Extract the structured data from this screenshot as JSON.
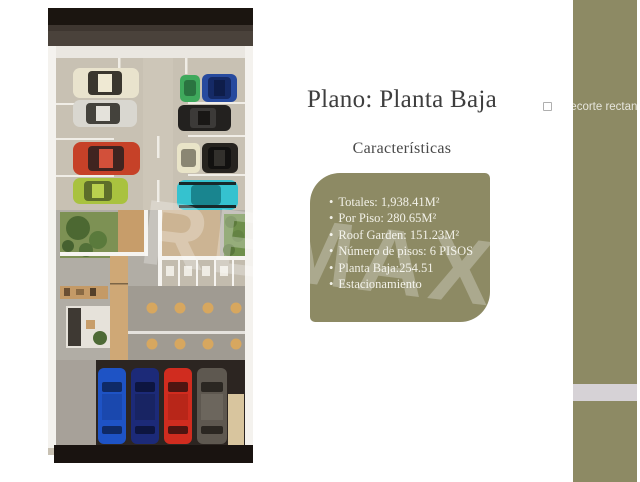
{
  "slide": {
    "title": "Plano: Planta Baja",
    "subtitle": "Características",
    "features": {
      "bullet": "•",
      "items": [
        "Totales: 1,938.41M²",
        "Por Piso: 280.65M²",
        "Roof Garden: 151.23M²",
        "Número de pisos: 6 PISOS",
        "Planta Baja:254.51",
        "Estacionamiento"
      ]
    },
    "watermark": {
      "text": "REMAX",
      "registered": "®"
    },
    "snip_hint": "Recorte rectan"
  },
  "colors": {
    "accent_olive": "#8d8a64",
    "band_light": "#d6d2d6",
    "title_text": "#3e3e3e",
    "box_text": "#f2f1e8"
  }
}
